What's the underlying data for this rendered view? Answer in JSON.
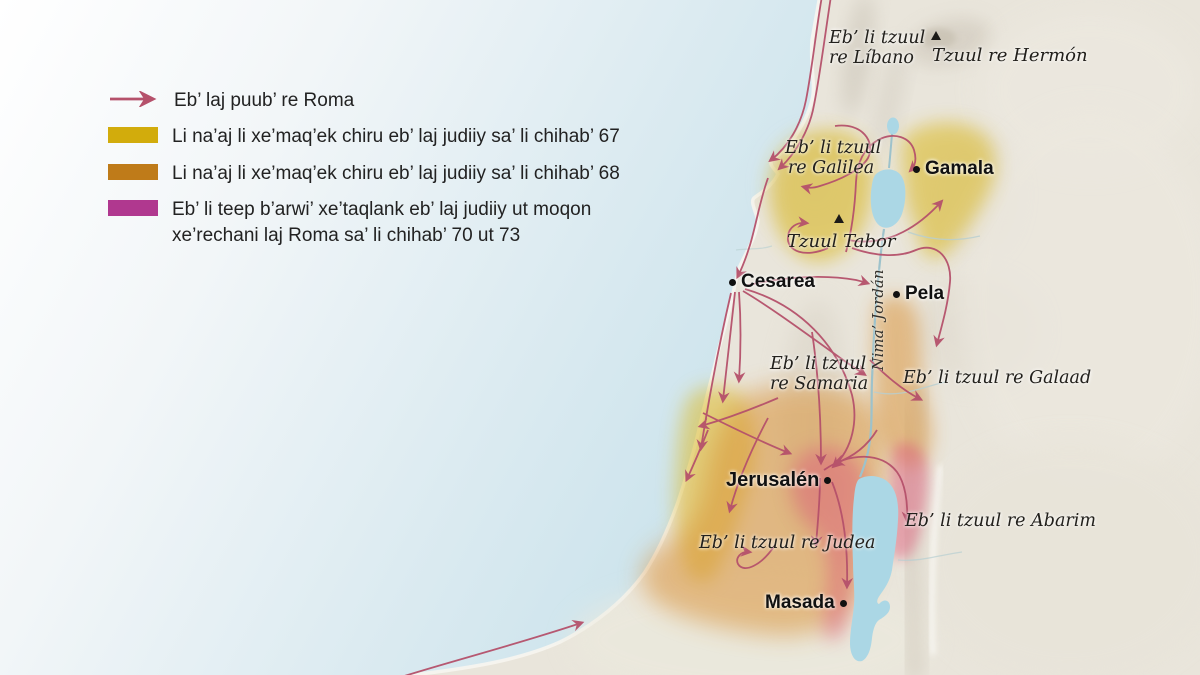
{
  "legend": {
    "items": [
      {
        "type": "arrow",
        "label": "Eb’ laj puub’ re Roma"
      },
      {
        "type": "swatch",
        "color_key": "yellow",
        "label": "Li na’aj li xe’maq’ek chiru eb’ laj judiiy sa’ li chihab’ 67"
      },
      {
        "type": "swatch",
        "color_key": "orange",
        "label": "Li na’aj li xe’maq’ek chiru eb’ laj judiiy sa’ li chihab’ 68"
      },
      {
        "type": "swatch",
        "color_key": "magenta",
        "label": "Eb’ li teep b’arwi’ xe’taqlank eb’ laj judiiy ut moqon xe’rechani laj Roma sa’ li chihab’ 70 ut 73"
      }
    ]
  },
  "map": {
    "regions": [
      {
        "id": "libano",
        "name": "Eb’ li tzuul re Líbano",
        "lines": [
          "Eb’ li tzuul",
          "re Líbano"
        ]
      },
      {
        "id": "galilea",
        "name": "Eb’ li tzuul re Galilea",
        "lines": [
          "Eb’ li tzuul",
          "re Galilea"
        ]
      },
      {
        "id": "samaria",
        "name": "Eb’ li tzuul re Samaria",
        "lines": [
          "Eb’ li tzuul",
          "re Samaria"
        ]
      },
      {
        "id": "galaad",
        "name": "Eb’ li tzuul re Galaad"
      },
      {
        "id": "judea",
        "name": "Eb’ li tzuul re Judea"
      },
      {
        "id": "abarim",
        "name": "Eb’ li tzuul re Abarim"
      }
    ],
    "mountains": [
      {
        "id": "hermon",
        "name": "Tzuul re Hermón"
      },
      {
        "id": "tabor",
        "name": "Tzuul Tabor"
      }
    ],
    "cities": [
      {
        "id": "gamala",
        "name": "Gamala"
      },
      {
        "id": "cesarea",
        "name": "Cesarea"
      },
      {
        "id": "pela",
        "name": "Pela"
      },
      {
        "id": "jerusalen",
        "name": "Jerusalén"
      },
      {
        "id": "masada",
        "name": "Masada"
      }
    ],
    "river": {
      "name": "Nima’ Jordán"
    }
  },
  "colors": {
    "rose": "#b5516b",
    "yellow": "#d2ac0c",
    "orange": "#bf7b19",
    "magenta": "#b0388f",
    "yellow_region": "#dcbc2e",
    "orange_region": "#d98f33",
    "pink_region": "#dd5f7c",
    "land": "#e9e5db",
    "water": "#abd7e5"
  }
}
